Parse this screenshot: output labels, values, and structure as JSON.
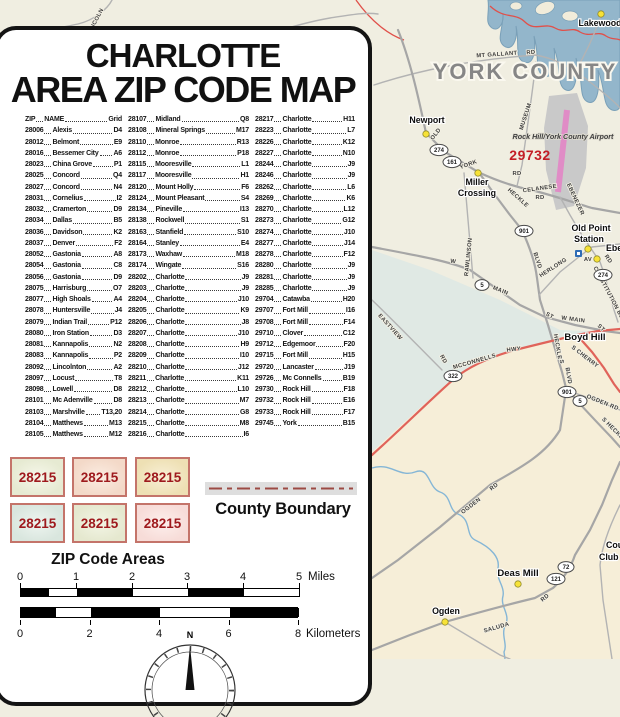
{
  "legend": {
    "title_line1": "CHARLOTTE",
    "title_line2": "AREA ZIP CODE MAP",
    "columns": [
      [
        {
          "z": "ZIP",
          "n": "NAME",
          "g": "Grid"
        },
        {
          "z": "28006",
          "n": "Alexis",
          "g": "D4"
        },
        {
          "z": "28012",
          "n": "Belmont",
          "g": "E9"
        },
        {
          "z": "28016",
          "n": "Bessemer City",
          "g": "A6"
        },
        {
          "z": "28023",
          "n": "China Grove",
          "g": "P1"
        },
        {
          "z": "28025",
          "n": "Concord",
          "g": "Q4"
        },
        {
          "z": "28027",
          "n": "Concord",
          "g": "N4"
        },
        {
          "z": "28031",
          "n": "Cornelius",
          "g": "I2"
        },
        {
          "z": "28032",
          "n": "Cramerton",
          "g": "D9"
        },
        {
          "z": "28034",
          "n": "Dallas",
          "g": "B5"
        },
        {
          "z": "28036",
          "n": "Davidson",
          "g": "K2"
        },
        {
          "z": "28037",
          "n": "Denver",
          "g": "F2"
        },
        {
          "z": "28052",
          "n": "Gastonia",
          "g": "A8"
        },
        {
          "z": "28054",
          "n": "Gastonia",
          "g": "C8"
        },
        {
          "z": "28056",
          "n": "Gastonia",
          "g": "D9"
        },
        {
          "z": "28075",
          "n": "Harrisburg",
          "g": "O7"
        },
        {
          "z": "28077",
          "n": "High Shoals",
          "g": "A4"
        },
        {
          "z": "28078",
          "n": "Huntersville",
          "g": "J4"
        },
        {
          "z": "28079",
          "n": "Indian Trail",
          "g": "P12"
        },
        {
          "z": "28080",
          "n": "Iron Station",
          "g": "D3"
        },
        {
          "z": "28081",
          "n": "Kannapolis",
          "g": "N2"
        },
        {
          "z": "28083",
          "n": "Kannapolis",
          "g": "P2"
        },
        {
          "z": "28092",
          "n": "Lincolnton",
          "g": "A2"
        },
        {
          "z": "28097",
          "n": "Locust",
          "g": "T8"
        },
        {
          "z": "28098",
          "n": "Lowell",
          "g": "D8"
        },
        {
          "z": "28101",
          "n": "Mc Adenville",
          "g": "D8"
        },
        {
          "z": "28103",
          "n": "Marshville",
          "g": "T13,20"
        },
        {
          "z": "28104",
          "n": "Matthews",
          "g": "M13"
        },
        {
          "z": "28105",
          "n": "Matthews",
          "g": "M12"
        }
      ],
      [
        {
          "z": "28107",
          "n": "Midland",
          "g": "Q8"
        },
        {
          "z": "28108",
          "n": "Mineral Springs",
          "g": "M17"
        },
        {
          "z": "28110",
          "n": "Monroe",
          "g": "R13"
        },
        {
          "z": "28112",
          "n": "Monroe",
          "g": "P18"
        },
        {
          "z": "28115",
          "n": "Mooresville",
          "g": "L1"
        },
        {
          "z": "28117",
          "n": "Mooresville",
          "g": "H1"
        },
        {
          "z": "28120",
          "n": "Mount Holly",
          "g": "F6"
        },
        {
          "z": "28124",
          "n": "Mount Pleasant",
          "g": "S4"
        },
        {
          "z": "28134",
          "n": "Pineville",
          "g": "I13"
        },
        {
          "z": "28138",
          "n": "Rockwell",
          "g": "S1"
        },
        {
          "z": "28163",
          "n": "Stanfield",
          "g": "S10"
        },
        {
          "z": "28164",
          "n": "Stanley",
          "g": "E4"
        },
        {
          "z": "28173",
          "n": "Waxhaw",
          "g": "M18"
        },
        {
          "z": "28174",
          "n": "Wingate",
          "g": "S16"
        },
        {
          "z": "28202",
          "n": "Charlotte",
          "g": "J9"
        },
        {
          "z": "28203",
          "n": "Charlotte",
          "g": "J9"
        },
        {
          "z": "28204",
          "n": "Charlotte",
          "g": "J10"
        },
        {
          "z": "28205",
          "n": "Charlotte",
          "g": "K9"
        },
        {
          "z": "28206",
          "n": "Charlotte",
          "g": "J8"
        },
        {
          "z": "28207",
          "n": "Charlotte",
          "g": "J10"
        },
        {
          "z": "28208",
          "n": "Charlotte",
          "g": "H9"
        },
        {
          "z": "28209",
          "n": "Charlotte",
          "g": "I10"
        },
        {
          "z": "28210",
          "n": "Charlotte",
          "g": "J12"
        },
        {
          "z": "28211",
          "n": "Charlotte",
          "g": "K11"
        },
        {
          "z": "28212",
          "n": "Charlotte",
          "g": "L10"
        },
        {
          "z": "28213",
          "n": "Charlotte",
          "g": "M7"
        },
        {
          "z": "28214",
          "n": "Charlotte",
          "g": "G8"
        },
        {
          "z": "28215",
          "n": "Charlotte",
          "g": "M8"
        },
        {
          "z": "28216",
          "n": "Charlotte",
          "g": "I6"
        }
      ],
      [
        {
          "z": "28217",
          "n": "Charlotte",
          "g": "H11"
        },
        {
          "z": "28223",
          "n": "Charlotte",
          "g": "L7"
        },
        {
          "z": "28226",
          "n": "Charlotte",
          "g": "K12"
        },
        {
          "z": "28227",
          "n": "Charlotte",
          "g": "N10"
        },
        {
          "z": "28244",
          "n": "Charlotte",
          "g": "J9"
        },
        {
          "z": "28246",
          "n": "Charlotte",
          "g": "J9"
        },
        {
          "z": "28262",
          "n": "Charlotte",
          "g": "L6"
        },
        {
          "z": "28269",
          "n": "Charlotte",
          "g": "K6"
        },
        {
          "z": "28270",
          "n": "Charlotte",
          "g": "L12"
        },
        {
          "z": "28273",
          "n": "Charlotte",
          "g": "G12"
        },
        {
          "z": "28274",
          "n": "Charlotte",
          "g": "J10"
        },
        {
          "z": "28277",
          "n": "Charlotte",
          "g": "J14"
        },
        {
          "z": "28278",
          "n": "Charlotte",
          "g": "F12"
        },
        {
          "z": "28280",
          "n": "Charlotte",
          "g": "J9"
        },
        {
          "z": "28281",
          "n": "Charlotte",
          "g": "J9"
        },
        {
          "z": "28285",
          "n": "Charlotte",
          "g": "J9"
        },
        {
          "z": "29704",
          "n": "Catawba",
          "g": "H20"
        },
        {
          "z": "29707",
          "n": "Fort Mill",
          "g": "I16"
        },
        {
          "z": "29708",
          "n": "Fort Mill",
          "g": "F14"
        },
        {
          "z": "29710",
          "n": "Clover",
          "g": "C12"
        },
        {
          "z": "29712",
          "n": "Edgemoor",
          "g": "F20"
        },
        {
          "z": "29715",
          "n": "Fort Mill",
          "g": "H15"
        },
        {
          "z": "29720",
          "n": "Lancaster",
          "g": "J19"
        },
        {
          "z": "29726",
          "n": "Mc Connells",
          "g": "B19"
        },
        {
          "z": "29730",
          "n": "Rock Hill",
          "g": "F18"
        },
        {
          "z": "29732",
          "n": "Rock Hill",
          "g": "E16"
        },
        {
          "z": "29733",
          "n": "Rock Hill",
          "g": "F17"
        },
        {
          "z": "29745",
          "n": "York",
          "g": "B15"
        }
      ]
    ],
    "swatches": {
      "label": "28215",
      "text_color": "#9e191d",
      "border_color": "#c4746a",
      "items": [
        {
          "fill": "#e6ead2",
          "inner": "#f6f7ea"
        },
        {
          "fill": "#f3d9c8",
          "inner": "#fbece2"
        },
        {
          "fill": "#eee0b4",
          "inner": "#f8efd6"
        },
        {
          "fill": "#d9e6de",
          "inner": "#eef5f0"
        },
        {
          "fill": "#e5e8cf",
          "inner": "#f3f5e5"
        },
        {
          "fill": "#f7dcd8",
          "inner": "#fdefec"
        }
      ]
    },
    "county_boundary_label": "County Boundary",
    "zip_areas_label": "ZIP Code Areas",
    "scale": {
      "miles_ticks": [
        "0",
        "1",
        "2",
        "3",
        "4",
        "5"
      ],
      "miles_unit": "Miles",
      "km_ticks": [
        "0",
        "2",
        "4",
        "6",
        "8"
      ],
      "km_unit": "Kilometers"
    },
    "compass_n": "N"
  },
  "map": {
    "county_label": "YORK COUNTY",
    "airport_label": "Rock Hill/York County Airport",
    "zip_code_red": "29732",
    "colors": {
      "base": "#f0eee1",
      "teal_area": "#e0e9e4",
      "tan_area": "#f6eed8",
      "lake": "#93b6cb",
      "boundary_red": "#e0504a",
      "red_road": "#e0635a",
      "runway_pink": "#e08cc6"
    },
    "place_lines": [
      "Lakewood",
      "Newport",
      "Miller",
      "Crossing",
      "Old Point",
      "Station",
      "Ebenezer",
      "Boyd Hill",
      "Deas Mill",
      "Ogden",
      "Country",
      "Club"
    ],
    "shields": [
      "274",
      "161",
      "901",
      "274",
      "5",
      "901",
      "5",
      "322",
      "72",
      "121"
    ],
    "road_labels": [
      "LINCOLN",
      "MT GALLANT",
      "RD",
      "MUSEUM",
      "OLD",
      "YORK",
      "RD",
      "CELANESE",
      "RD",
      "EBENEZER",
      "HECKLE",
      "BLVD",
      "HERLONG",
      "AV",
      "RD",
      "CONSTITUTION BLVD",
      "RAWLINSON",
      "W",
      "MAIN",
      "ST",
      "W MAIN",
      "ST",
      "EASTVIEW",
      "MCCONNELLS",
      "HWY",
      "RD",
      "HECKLE",
      "S",
      "BLVD",
      "OGDEN RD",
      "S HECKLE",
      "OGDEN",
      "RD",
      "SALUDA",
      "RD",
      "S CHERRY"
    ]
  }
}
